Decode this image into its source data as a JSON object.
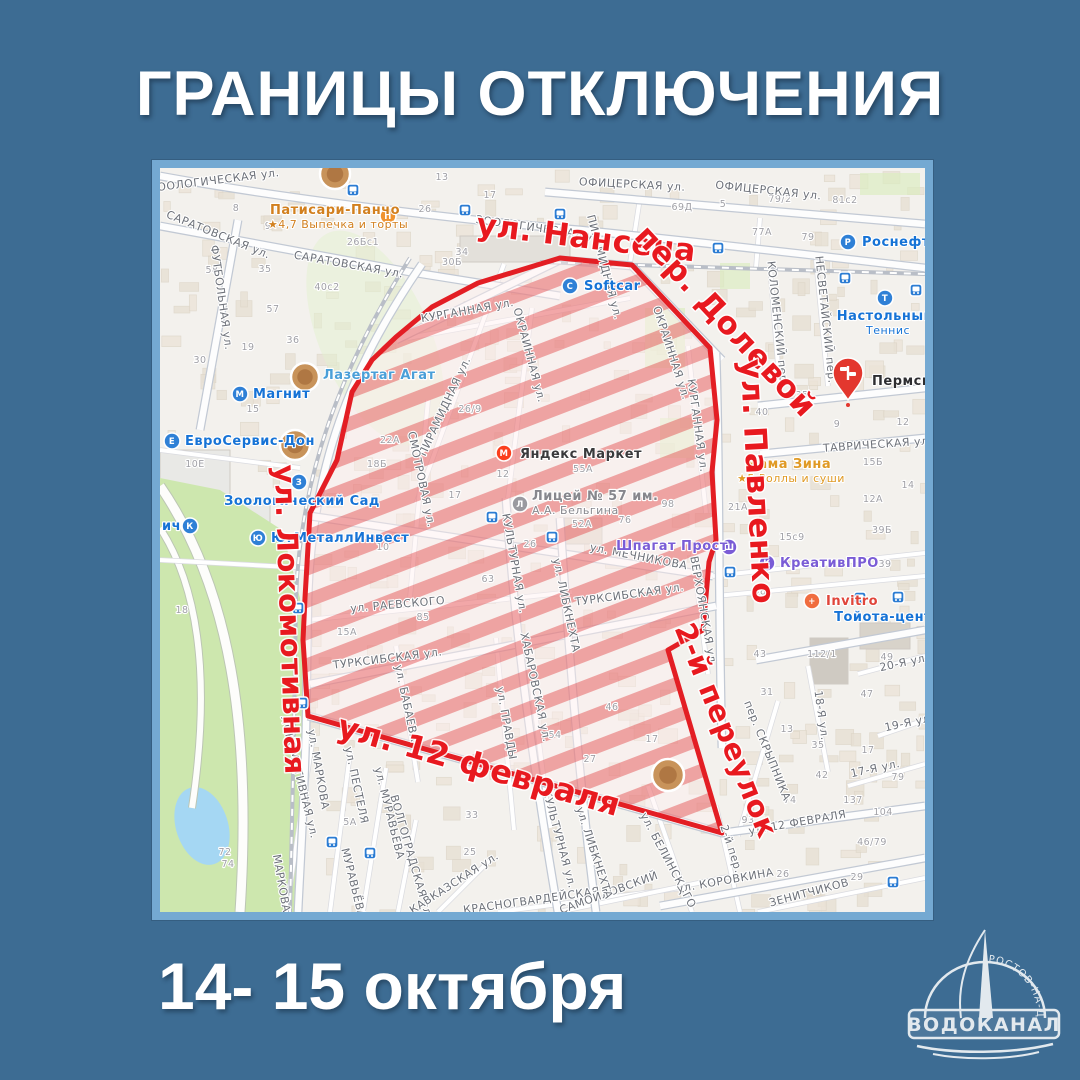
{
  "title": "ГРАНИЦЫ ОТКЛЮЧЕНИЯ",
  "date_range": "14- 15 октября",
  "logo": {
    "org": "ВОДОКАНАЛ",
    "city": "РОСТОВ-НА-ДОНУ"
  },
  "colors": {
    "background": "#3d6c93",
    "frame": "#74a9d2",
    "outage_border": "#e31e24",
    "outage_stripe": "rgba(223,55,58,0.42)",
    "outage_tint": "rgba(255,240,240,0.45)",
    "outage_label": "#e8191f",
    "street_label": "#6e727a",
    "poi_blue": "#1673d6",
    "poi_violet": "#7a5cd6",
    "poi_orange": "#d98а2b"
  },
  "map": {
    "outage_polygon": [
      [
        148,
        548
      ],
      [
        143,
        472
      ],
      [
        145,
        430
      ],
      [
        150,
        345
      ],
      [
        177,
        292
      ],
      [
        192,
        224
      ],
      [
        212,
        192
      ],
      [
        236,
        169
      ],
      [
        272,
        139
      ],
      [
        318,
        115
      ],
      [
        400,
        90
      ],
      [
        472,
        97
      ],
      [
        550,
        180
      ],
      [
        557,
        252
      ],
      [
        552,
        304
      ],
      [
        556,
        372
      ],
      [
        549,
        394
      ],
      [
        543,
        462
      ],
      [
        508,
        482
      ],
      [
        562,
        665
      ]
    ],
    "outage_street_labels": [
      {
        "text": "ул. Нансена",
        "x": 425,
        "y": 80,
        "rot": 7,
        "size": 31
      },
      {
        "text": "пер. Долевой",
        "x": 558,
        "y": 160,
        "rot": 47,
        "size": 31
      },
      {
        "text": "ул. Павленко",
        "x": 587,
        "y": 314,
        "rot": 87,
        "size": 31
      },
      {
        "text": "ул. Локомотивная",
        "x": 120,
        "y": 452,
        "rot": 88,
        "size": 29
      },
      {
        "text": "ул. 12 февраля",
        "x": 316,
        "y": 608,
        "rot": 16,
        "size": 32
      },
      {
        "text": "2-й переулок",
        "x": 557,
        "y": 566,
        "rot": 68,
        "size": 29
      }
    ],
    "street_labels": [
      {
        "text": "ЗООЛОГИЧЕСКАЯ ул.",
        "x": 55,
        "y": 16,
        "rot": -7
      },
      {
        "text": "ЗООЛОГИЧЕСКАЯ ул.",
        "x": 380,
        "y": 64,
        "rot": 8
      },
      {
        "text": "ОФИЦЕРСКАЯ ул.",
        "x": 472,
        "y": 20,
        "rot": 3
      },
      {
        "text": "ОФИЦЕРСКАЯ ул.",
        "x": 608,
        "y": 26,
        "rot": 6
      },
      {
        "text": "САРАТОВСКАЯ ул.",
        "x": 57,
        "y": 70,
        "rot": 22
      },
      {
        "text": "САРАТОВСКАЯ ул.",
        "x": 188,
        "y": 100,
        "rot": 10
      },
      {
        "text": "ФУТБОЛЬНАЯ ул.",
        "x": 58,
        "y": 130,
        "rot": 82
      },
      {
        "text": "КУРГАННАЯ ул.",
        "x": 308,
        "y": 146,
        "rot": -10
      },
      {
        "text": "КУРГАННАЯ ул.",
        "x": 534,
        "y": 258,
        "rot": 82
      },
      {
        "text": "ПИРАМИДНАЯ ул.",
        "x": 288,
        "y": 240,
        "rot": -65
      },
      {
        "text": "ПИРАМИДНАЯ ул.",
        "x": 441,
        "y": 100,
        "rot": 75
      },
      {
        "text": "ОКРАИННАЯ ул.",
        "x": 366,
        "y": 188,
        "rot": 75
      },
      {
        "text": "СМОТРОВАЯ ул.",
        "x": 258,
        "y": 312,
        "rot": 78
      },
      {
        "text": "КУЛЬТУРНАЯ ул.",
        "x": 351,
        "y": 396,
        "rot": 80
      },
      {
        "text": "КУЛЬТУРНАЯ ул.",
        "x": 396,
        "y": 672,
        "rot": 75
      },
      {
        "text": "ул. МЕЧНИКОВА",
        "x": 478,
        "y": 392,
        "rot": 11
      },
      {
        "text": "ТУРКСИБСКАЯ ул.",
        "x": 470,
        "y": 430,
        "rot": -8
      },
      {
        "text": "ТУРКСИБСКАЯ ул.",
        "x": 228,
        "y": 494,
        "rot": -7
      },
      {
        "text": "ул. РАЕВСКОГО",
        "x": 238,
        "y": 440,
        "rot": -5
      },
      {
        "text": "ул. БАБАЕВА",
        "x": 243,
        "y": 536,
        "rot": 78
      },
      {
        "text": "ЛОКОМОТИВНАЯ ул.",
        "x": 136,
        "y": 610,
        "rot": 76
      },
      {
        "text": "ул. МАРКОВА",
        "x": 155,
        "y": 602,
        "rot": 80
      },
      {
        "text": "МАРКОВА",
        "x": 118,
        "y": 716,
        "rot": 80
      },
      {
        "text": "ул. ПЕСТЕЛЯ",
        "x": 193,
        "y": 618,
        "rot": 78
      },
      {
        "text": "ул. МУРАВЬЁВА",
        "x": 226,
        "y": 646,
        "rot": 76
      },
      {
        "text": "МУРАВЬЁВА",
        "x": 190,
        "y": 716,
        "rot": 76
      },
      {
        "text": "ВОЛГОГРАДСКАЯ ул.",
        "x": 248,
        "y": 690,
        "rot": 74
      },
      {
        "text": "КАВКАЗСКАЯ ул.",
        "x": 296,
        "y": 718,
        "rot": -33
      },
      {
        "text": "КРАСНОГВАРДЕЙСКАЯ",
        "x": 372,
        "y": 736,
        "rot": -8
      },
      {
        "text": "САМОЙЛОВСКИЙ",
        "x": 450,
        "y": 728,
        "rot": -20
      },
      {
        "text": "ул. ЛИБКНЕХТА",
        "x": 431,
        "y": 686,
        "rot": 72
      },
      {
        "text": "ул. ЛИБКНЕХТА",
        "x": 403,
        "y": 438,
        "rot": 78
      },
      {
        "text": "ХАБАРОВСКАЯ ул.",
        "x": 372,
        "y": 520,
        "rot": 78
      },
      {
        "text": "ул. ПРАВДЫ",
        "x": 343,
        "y": 556,
        "rot": 80
      },
      {
        "text": "ул. БЕЛИНСКОГО",
        "x": 505,
        "y": 694,
        "rot": 62
      },
      {
        "text": "2-й пер.",
        "x": 568,
        "y": 682,
        "rot": 72
      },
      {
        "text": "ул. КОРОВКИНА",
        "x": 566,
        "y": 716,
        "rot": -10
      },
      {
        "text": "ЗЕНИТЧИКОВ",
        "x": 650,
        "y": 728,
        "rot": -15
      },
      {
        "text": "ул. 12 ФЕВРАЛЯ",
        "x": 638,
        "y": 658,
        "rot": -10
      },
      {
        "text": "пер. СКРЫПНИКА",
        "x": 604,
        "y": 584,
        "rot": 68
      },
      {
        "text": "17-Я ул.",
        "x": 716,
        "y": 604,
        "rot": -12
      },
      {
        "text": "18-Я ул.",
        "x": 658,
        "y": 548,
        "rot": 82
      },
      {
        "text": "19-Я ул.",
        "x": 750,
        "y": 558,
        "rot": -12
      },
      {
        "text": "20-Я ул.",
        "x": 745,
        "y": 498,
        "rot": -12
      },
      {
        "text": "ТАВРИЧЕСКАЯ ул.",
        "x": 718,
        "y": 280,
        "rot": -4
      },
      {
        "text": "КОЛОМЕНСКИЙ пер.",
        "x": 614,
        "y": 156,
        "rot": 84
      },
      {
        "text": "НЕСВЕТАЙСКИЙ пер.",
        "x": 662,
        "y": 152,
        "rot": 84
      },
      {
        "text": "ВЕРХОЯНСКАЯ ул.",
        "x": 540,
        "y": 444,
        "rot": 80
      },
      {
        "text": "ОКРАИННАЯ ул.",
        "x": 508,
        "y": 186,
        "rot": 72
      }
    ],
    "house_numbers": [
      [
        "8",
        76,
        43
      ],
      [
        "9",
        108,
        61
      ],
      [
        "26Бс1",
        203,
        77
      ],
      [
        "30Б",
        292,
        97
      ],
      [
        "13",
        282,
        12
      ],
      [
        "17",
        330,
        30
      ],
      [
        "26",
        265,
        44
      ],
      [
        "34",
        302,
        87
      ],
      [
        "40с2",
        167,
        122
      ],
      [
        "57",
        113,
        144
      ],
      [
        "58",
        52,
        105
      ],
      [
        "35",
        105,
        104
      ],
      [
        "69Д",
        522,
        42
      ],
      [
        "5",
        563,
        39
      ],
      [
        "79/2",
        620,
        34
      ],
      [
        "81с2",
        685,
        35
      ],
      [
        "77А",
        602,
        67
      ],
      [
        "79",
        648,
        72
      ],
      [
        "15Б",
        713,
        297
      ],
      [
        "9",
        677,
        259
      ],
      [
        "12",
        743,
        257
      ],
      [
        "15",
        93,
        244
      ],
      [
        "10Е",
        35,
        299
      ],
      [
        "19",
        88,
        182
      ],
      [
        "30",
        40,
        195
      ],
      [
        "36",
        133,
        175
      ],
      [
        "22А",
        230,
        275
      ],
      [
        "18Б",
        217,
        299
      ],
      [
        "10",
        223,
        382
      ],
      [
        "26/9",
        310,
        244
      ],
      [
        "55А",
        423,
        304
      ],
      [
        "12",
        343,
        309
      ],
      [
        "17",
        295,
        330
      ],
      [
        "52А",
        422,
        359
      ],
      [
        "26",
        370,
        379
      ],
      [
        "98",
        508,
        339
      ],
      [
        "76",
        465,
        355
      ],
      [
        "63",
        328,
        414
      ],
      [
        "35",
        642,
        230
      ],
      [
        "40",
        602,
        247
      ],
      [
        "14",
        748,
        320
      ],
      [
        "12А",
        713,
        334
      ],
      [
        "39Б",
        722,
        365
      ],
      [
        "15с9",
        632,
        372
      ],
      [
        "39",
        725,
        399
      ],
      [
        "29",
        600,
        429
      ],
      [
        "21А",
        578,
        342
      ],
      [
        "43",
        600,
        489
      ],
      [
        "112/1",
        662,
        489
      ],
      [
        "49",
        727,
        492
      ],
      [
        "31",
        607,
        527
      ],
      [
        "47",
        707,
        529
      ],
      [
        "13",
        627,
        564
      ],
      [
        "35",
        658,
        580
      ],
      [
        "17",
        708,
        585
      ],
      [
        "42",
        662,
        610
      ],
      [
        "74",
        630,
        635
      ],
      [
        "137",
        693,
        635
      ],
      [
        "104",
        723,
        647
      ],
      [
        "93",
        588,
        655
      ],
      [
        "46/79",
        712,
        677
      ],
      [
        "79",
        738,
        612
      ],
      [
        "18",
        22,
        445
      ],
      [
        "85",
        263,
        452
      ],
      [
        "15А",
        187,
        467
      ],
      [
        "72",
        65,
        687
      ],
      [
        "74",
        68,
        699
      ],
      [
        "5А",
        190,
        657
      ],
      [
        "33",
        312,
        650
      ],
      [
        "25",
        310,
        687
      ],
      [
        "54",
        395,
        570
      ],
      [
        "27",
        430,
        594
      ],
      [
        "46",
        452,
        542
      ],
      [
        "17",
        492,
        574
      ],
      [
        "26",
        623,
        709
      ],
      [
        "29",
        697,
        712
      ]
    ],
    "pois": [
      {
        "text": "Патисари-Панчо",
        "sub": "★4,7 Выпечка и торты",
        "tx": 175,
        "ty": 46,
        "anchor": "middle",
        "color": "#d2801f",
        "icon": {
          "x": 228,
          "y": 48,
          "c": "#f0932f",
          "l": "П"
        }
      },
      {
        "text": "Softcar",
        "tx": 424,
        "ty": 122,
        "anchor": "start",
        "color": "#1673d6",
        "icon": {
          "x": 410,
          "y": 118,
          "c": "#2f80d6",
          "l": "С"
        }
      },
      {
        "text": "Роснефть",
        "tx": 702,
        "ty": 78,
        "anchor": "start",
        "color": "#1673d6",
        "icon": {
          "x": 688,
          "y": 74,
          "c": "#2f80d6",
          "l": "Р"
        }
      },
      {
        "text": "Настольный",
        "sub": "Теннис",
        "tx": 725,
        "ty": 152,
        "anchor": "middle",
        "color": "#1673d6",
        "icon": {
          "x": 725,
          "y": 130,
          "c": "#2f80d6",
          "l": "Т"
        }
      },
      {
        "text": "Пермска",
        "tx": 712,
        "ty": 217,
        "anchor": "start",
        "color": "#2e2e31"
      },
      {
        "text": "Лазертаг Агат",
        "tx": 163,
        "ty": 211,
        "anchor": "start",
        "color": "#4a9fd8"
      },
      {
        "text": "Магнит",
        "tx": 93,
        "ty": 230,
        "anchor": "start",
        "color": "#1673d6",
        "icon": {
          "x": 80,
          "y": 226,
          "c": "#2f80d6",
          "l": "М"
        }
      },
      {
        "text": "ЕвроСервис-Дон",
        "tx": 25,
        "ty": 277,
        "anchor": "start",
        "color": "#1673d6",
        "icon": {
          "x": 12,
          "y": 273,
          "c": "#2f80d6",
          "l": "Е"
        }
      },
      {
        "text": "Зоологический Сад",
        "tx": 142,
        "ty": 337,
        "anchor": "middle",
        "color": "#1673d6",
        "icon": {
          "x": 139,
          "y": 314,
          "c": "#2f80d6",
          "l": "З"
        }
      },
      {
        "text": "ЮгМеталлИнвест",
        "tx": 111,
        "ty": 374,
        "anchor": "start",
        "color": "#1673d6",
        "icon": {
          "x": 98,
          "y": 370,
          "c": "#2f80d6",
          "l": "Ю"
        }
      },
      {
        "text": "ич",
        "tx": 2,
        "ty": 362,
        "anchor": "start",
        "color": "#1673d6",
        "icon": {
          "x": 30,
          "y": 358,
          "c": "#2f80d6",
          "l": "К"
        }
      },
      {
        "text": "Яндекс Маркет",
        "tx": 360,
        "ty": 290,
        "anchor": "start",
        "color": "#3a3a3c",
        "icon": {
          "x": 344,
          "y": 285,
          "c": "#fb3f1d",
          "l": "М"
        }
      },
      {
        "text": "Лицей № 57 им.",
        "sub": "А.А. Бельгина",
        "tx": 372,
        "ty": 332,
        "anchor": "start",
        "color": "#87878d",
        "icon": {
          "x": 360,
          "y": 336,
          "c": "#9a9aa0",
          "l": "Л"
        }
      },
      {
        "text": "Шпагат Прост",
        "tx": 512,
        "ty": 382,
        "anchor": "middle",
        "color": "#7a5cd6",
        "icon": {
          "x": 569,
          "y": 379,
          "c": "#7a5cd6",
          "l": "Ш"
        }
      },
      {
        "text": "КреативПРО",
        "tx": 620,
        "ty": 399,
        "anchor": "start",
        "color": "#7a5cd6",
        "icon": {
          "x": 607,
          "y": 395,
          "c": "#7a5cd6",
          "l": "К"
        }
      },
      {
        "text": "Мама Зина",
        "sub": "★5 Роллы и суши",
        "tx": 628,
        "ty": 300,
        "anchor": "middle",
        "color": "#e09a25"
      },
      {
        "text": "Invitro",
        "tx": 666,
        "ty": 437,
        "anchor": "start",
        "color": "#e0453a",
        "icon": {
          "x": 652,
          "y": 433,
          "c": "#f06d3f",
          "l": "+"
        }
      },
      {
        "text": "Тойота-центр",
        "tx": 728,
        "ty": 453,
        "anchor": "middle",
        "color": "#1673d6"
      }
    ],
    "photo_markers": [
      {
        "x": 175,
        "y": 6,
        "r": 15
      },
      {
        "x": 145,
        "y": 209,
        "r": 14
      },
      {
        "x": 135,
        "y": 277,
        "r": 15
      },
      {
        "x": 508,
        "y": 607,
        "r": 16
      }
    ],
    "pin_marker": {
      "x": 688,
      "y": 214,
      "label": "Пермска"
    },
    "transit_stops": [
      [
        193,
        22
      ],
      [
        305,
        42
      ],
      [
        400,
        46
      ],
      [
        558,
        80
      ],
      [
        685,
        110
      ],
      [
        756,
        122
      ],
      [
        332,
        349
      ],
      [
        392,
        369
      ],
      [
        138,
        440
      ],
      [
        142,
        535
      ],
      [
        172,
        674
      ],
      [
        210,
        685
      ],
      [
        733,
        714
      ],
      [
        700,
        430
      ],
      [
        738,
        429
      ],
      [
        570,
        404
      ]
    ]
  }
}
